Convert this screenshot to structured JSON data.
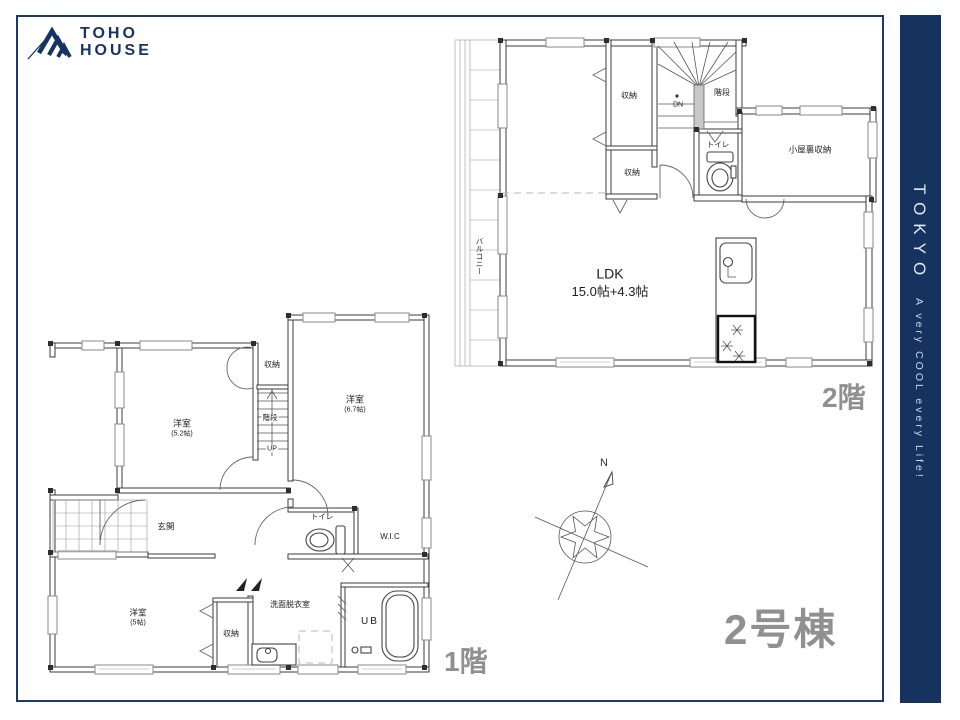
{
  "logo": {
    "line1": "TOHO",
    "line2": "HOUSE"
  },
  "sidebar": {
    "brand": "TOKYO",
    "tagline": "A very COOL every Life!"
  },
  "building": {
    "label": "2号棟"
  },
  "compass": {
    "north": "N"
  },
  "floor2": {
    "name": "2階",
    "rooms": {
      "ldk": "LDK",
      "ldk_size": "15.0帖+4.3帖",
      "closet_top": "収納",
      "closet_mid": "収納",
      "stairs": "階段",
      "dn": "DN",
      "toilet": "トイレ",
      "attic": "小屋裏収納",
      "balcony": "バルコニー"
    }
  },
  "floor1": {
    "name": "1階",
    "rooms": {
      "bed1": "洋室",
      "bed1_size": "(5.2帖)",
      "bed2": "洋室",
      "bed2_size": "(6.7帖)",
      "bed3": "洋室",
      "bed3_size": "(5帖)",
      "closet_top": "収納",
      "closet_bottom": "収納",
      "stairs": "階段",
      "up": "UP",
      "entrance": "玄関",
      "toilet": "トイレ",
      "wic": "W.I.C",
      "washroom": "洗面脱衣室",
      "bath": "UB"
    }
  }
}
